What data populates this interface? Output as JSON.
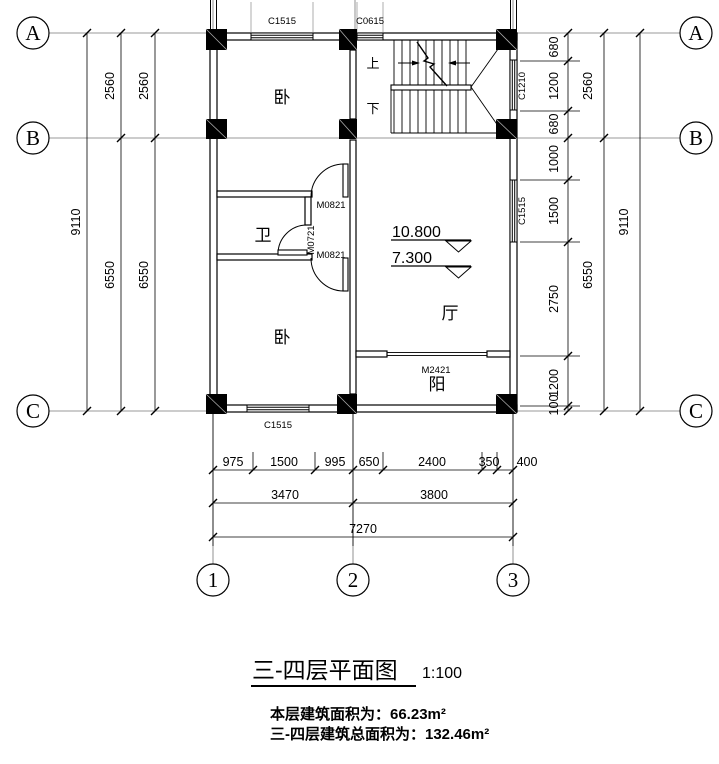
{
  "title": {
    "text": "三-四层平面图",
    "scale": "1:100"
  },
  "notes": {
    "line1": "本层建筑面积为：66.23m²",
    "line2": "三-四层建筑总面积为：132.46m²"
  },
  "axes": {
    "a": "A",
    "b": "B",
    "c": "C",
    "n1": "1",
    "n2": "2",
    "n3": "3"
  },
  "rooms": {
    "bedroom_top": "卧",
    "bathroom": "卫",
    "bedroom_bottom": "卧",
    "hall": "厅",
    "balcony": "阳"
  },
  "stair": {
    "up_label": "上",
    "down_label": "下"
  },
  "levels": {
    "upper": "10.800",
    "lower": "7.300"
  },
  "windows": {
    "bedroom_top": "C1515",
    "stair_top": "C0615",
    "stair_right": "C1210",
    "hall_right": "C1515",
    "bedroom_bottom": "C1515"
  },
  "doors": {
    "bedroom_top": "M0821",
    "bathroom": "M0721",
    "bedroom_bottom": "M0821",
    "balcony": "M2421"
  },
  "dimensions": {
    "left": {
      "total": "9110",
      "ab": "2560",
      "bc": "6550"
    },
    "right": {
      "ab_segments": [
        "680",
        "1200",
        "680"
      ],
      "bc_segments": [
        "1000",
        "1500",
        "2750",
        "1200",
        "100"
      ],
      "ab": "2560",
      "bc": "6550",
      "total": "9110"
    },
    "bottom": {
      "segments": [
        "975",
        "1500",
        "995",
        "650",
        "2400",
        "350",
        "400"
      ],
      "spans": [
        "3470",
        "3800"
      ],
      "total": "7270"
    }
  }
}
